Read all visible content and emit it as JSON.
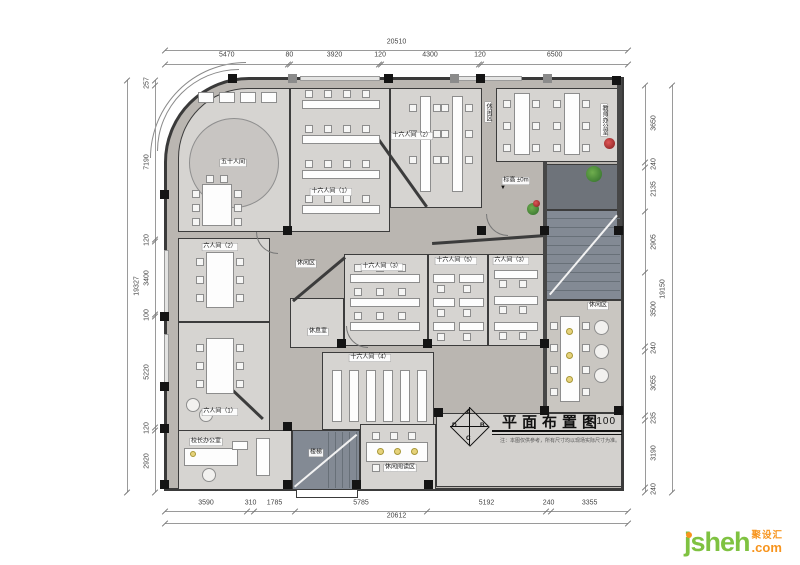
{
  "title_block": {
    "title": "平面布置图",
    "scale": "1:100",
    "note": "注：本图仅供参考，所有尺寸均以现场实际尺寸为准。",
    "compass": {
      "top": "A",
      "right": "B",
      "bottom": "C",
      "left": "D"
    }
  },
  "logo": {
    "name": "jsheh",
    "tld": ".com",
    "cn": "聚设汇"
  },
  "dimensions": {
    "top": {
      "total": "20510",
      "segments": [
        "5470",
        "80",
        "3920",
        "120",
        "4300",
        "120",
        "6500"
      ]
    },
    "bottom": {
      "total": "20612",
      "segments": [
        "3590",
        "310",
        "1785",
        "5785",
        "5192",
        "240",
        "3355"
      ]
    },
    "left": {
      "total": "19327",
      "segments": [
        "257",
        "7190",
        "120",
        "3400",
        "100",
        "5220",
        "120",
        "2920"
      ]
    },
    "right": {
      "total": "19150",
      "segments": [
        "3650",
        "240",
        "2135",
        "2905",
        "3500",
        "240",
        "3055",
        "235",
        "3190",
        "240"
      ]
    }
  },
  "plan": {
    "room_labels": [
      {
        "text": "五十人间",
        "x": 233,
        "y": 163
      },
      {
        "text": "十六人间（1）",
        "x": 331,
        "y": 192
      },
      {
        "text": "十六人间（2）",
        "x": 412,
        "y": 136
      },
      {
        "text": "休闲区",
        "x": 488,
        "y": 112,
        "vertical": true
      },
      {
        "text": "教师办公室",
        "x": 604,
        "y": 120,
        "vertical": true
      },
      {
        "text": "六人间（2）",
        "x": 220,
        "y": 247
      },
      {
        "text": "六人间（1）",
        "x": 220,
        "y": 412
      },
      {
        "text": "休闲区",
        "x": 306,
        "y": 264
      },
      {
        "text": "休息室",
        "x": 318,
        "y": 332
      },
      {
        "text": "十六人间（3）",
        "x": 382,
        "y": 267
      },
      {
        "text": "十六人间（5）",
        "x": 456,
        "y": 261
      },
      {
        "text": "六人间（3）",
        "x": 511,
        "y": 261
      },
      {
        "text": "十六人间（4）",
        "x": 370,
        "y": 358
      },
      {
        "text": "休闲区",
        "x": 598,
        "y": 306
      },
      {
        "text": "校长办公室",
        "x": 206,
        "y": 442
      },
      {
        "text": "楼梯",
        "x": 316,
        "y": 453
      },
      {
        "text": "休闲阅读区",
        "x": 400,
        "y": 468
      },
      {
        "text": "标高 ±0m",
        "x": 516,
        "y": 181
      },
      {
        "text": "▼",
        "x": 503,
        "y": 188,
        "plain": true,
        "name": "elevation-marker-icon"
      }
    ]
  }
}
